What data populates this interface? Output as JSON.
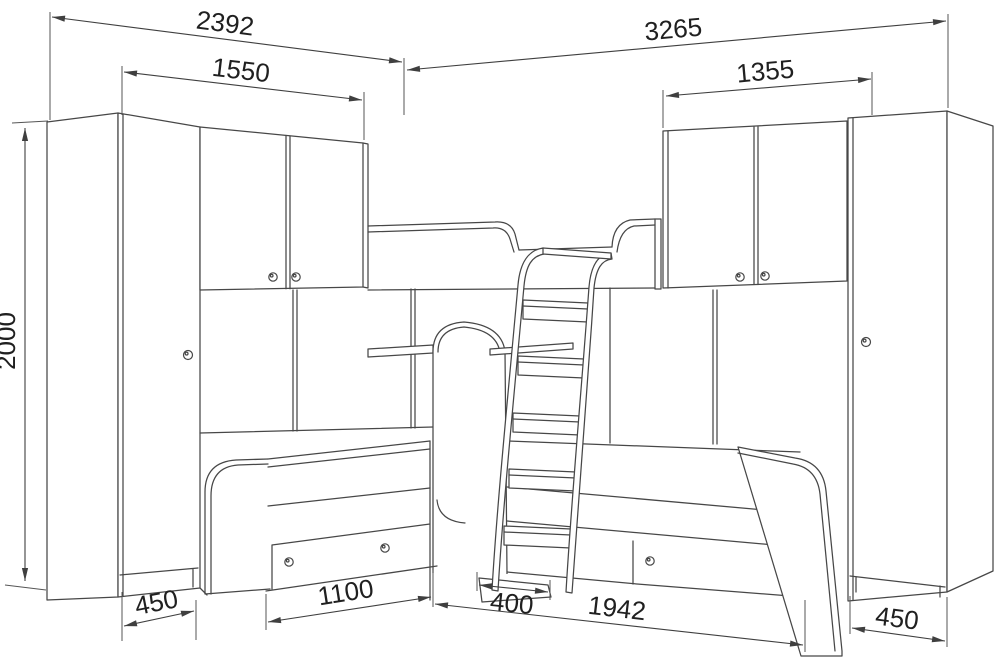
{
  "page": {
    "background": "#ffffff",
    "line_color": "#474747",
    "text_color": "#202020",
    "content": "perspective line drawing of corner children furniture set: two wardrobes, two overhead cabinets, two lower beds with drawers, upper bunk bed and ladder"
  },
  "drawing": {
    "units": "mm",
    "dimensions": {
      "left_total": "2392",
      "right_total": "3265",
      "left_upper_cabinet": "1550",
      "right_upper_cabinet": "1355",
      "height": "2000",
      "left_wardrobe_depth": "450",
      "left_bed": "1100",
      "ladder": "400",
      "right_bed": "1942",
      "right_wardrobe_depth": "450"
    }
  }
}
